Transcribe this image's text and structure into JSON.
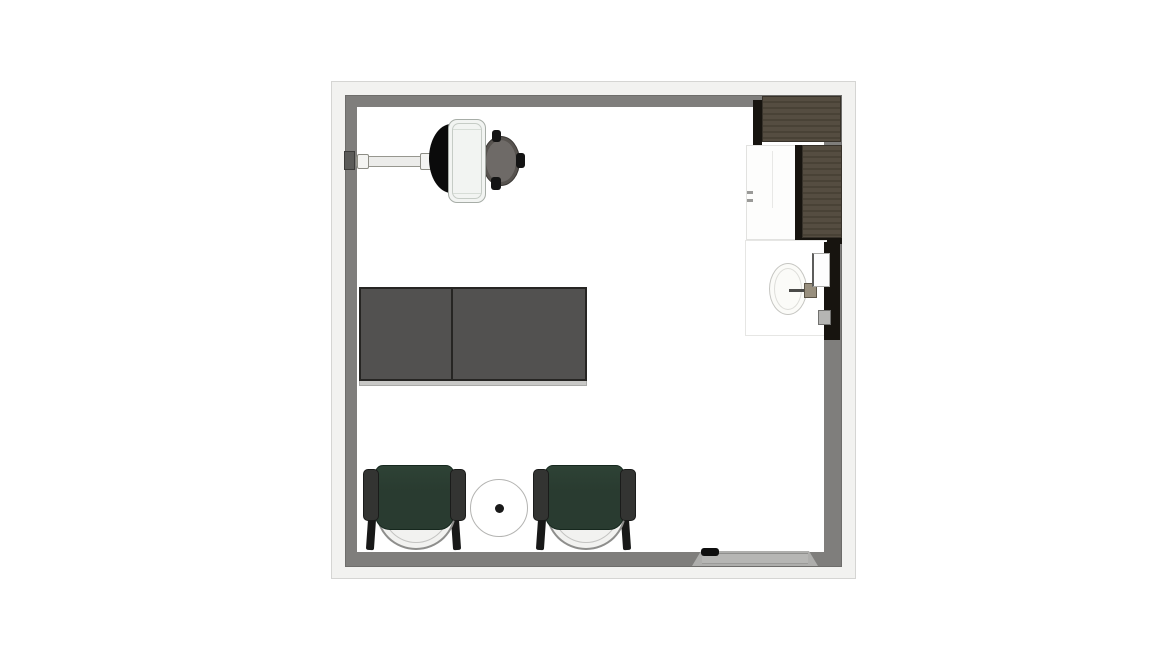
{
  "colors": {
    "background": "#ffffff",
    "wall_outer": "#f2f2f0",
    "wall_outline": "#d5d5d3",
    "wall_inner": "#7f7e7c",
    "cabinet_wood": "#554d41",
    "cabinet_grain": "#494236",
    "cabinet_shadow": "#17140f",
    "table_top": "#525150",
    "table_edge": "#262523",
    "chair_green": "#293b30",
    "chair_armrest": "#333432",
    "stool_gray": "#6e6a67",
    "exam_chair_white": "#f2f4f2",
    "pad_black": "#0b0b0b",
    "sink_white": "#fbfbf8",
    "threshold_gray": "#aeaeac"
  },
  "room": {
    "label": "Top-down floor plan of a square room"
  },
  "furniture": {
    "bracket": {
      "label": "Wall mount bracket"
    },
    "arm": {
      "label": "Wall-mounted equipment arm"
    },
    "headrest": {
      "label": "Exam chair black pad"
    },
    "exam_chair": {
      "label": "Exam chair"
    },
    "stool": {
      "label": "Operator stool"
    },
    "cabinet_top": {
      "label": "Dark wood upper cabinet along top wall"
    },
    "cabinet_right": {
      "label": "Dark wood upper cabinet along right wall"
    },
    "base_cabinet": {
      "label": "White base cabinet"
    },
    "sink_counter": {
      "label": "Sink counter"
    },
    "sink": {
      "label": "Oval sink basin"
    },
    "faucet": {
      "label": "Wall faucet"
    },
    "dispenser": {
      "label": "Wall-mounted dispenser"
    },
    "wall_box": {
      "label": "Small wall box"
    },
    "side_panel": {
      "label": "Dark cabinet side panel"
    },
    "table_left": {
      "label": "Work table, left section"
    },
    "table_right": {
      "label": "Work table, right section"
    },
    "chair_left": {
      "label": "Green guest chair, left"
    },
    "chair_right": {
      "label": "Green guest chair, right"
    },
    "side_table": {
      "label": "Round side table"
    },
    "threshold": {
      "label": "Sliding door threshold"
    },
    "door_handle": {
      "label": "Door handle"
    }
  }
}
